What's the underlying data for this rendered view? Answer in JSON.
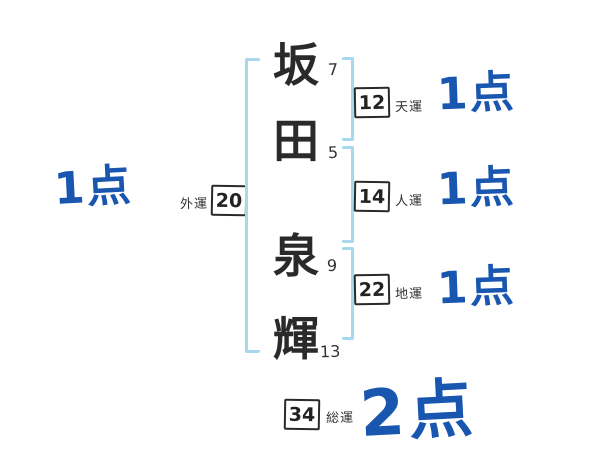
{
  "name": {
    "characters": [
      {
        "char": "坂",
        "strokes": "7"
      },
      {
        "char": "田",
        "strokes": "5"
      },
      {
        "char": "泉",
        "strokes": "9"
      },
      {
        "char": "輝",
        "strokes": "13"
      }
    ]
  },
  "fortunes": {
    "ten": {
      "label": "天運",
      "value": "12",
      "score": "1点"
    },
    "jin": {
      "label": "人運",
      "value": "14",
      "score": "1点"
    },
    "chi": {
      "label": "地運",
      "value": "22",
      "score": "1点"
    },
    "gai": {
      "label": "外運",
      "value": "20",
      "score": "1点"
    },
    "sou": {
      "label": "総運",
      "value": "34",
      "score": "2点"
    }
  },
  "colors": {
    "score_blue": "#1856b0",
    "bracket_blue": "#a8d8ee",
    "ink": "#2a2a2a"
  }
}
